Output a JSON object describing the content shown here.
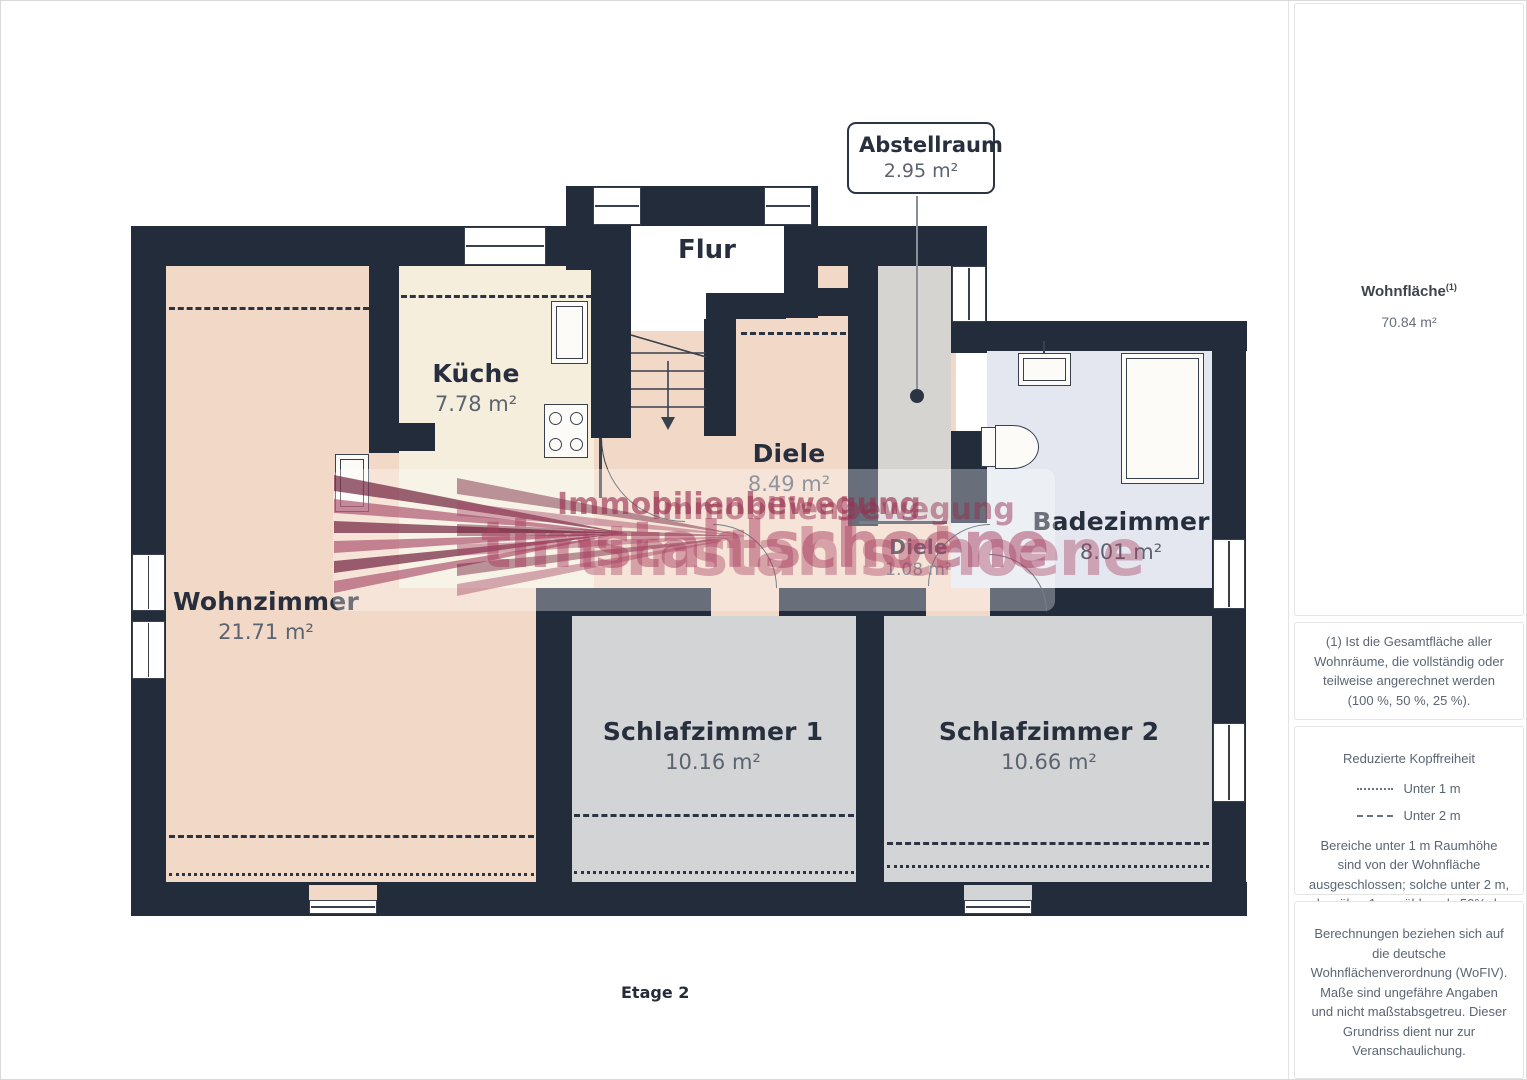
{
  "colors": {
    "wall": "#232c3b",
    "living_pink": "#f2d8c6",
    "kitchen_cream": "#f5eedc",
    "bath_lavender": "#e4e7ef",
    "bedroom_gray": "#d3d4d6",
    "storage_gray": "#d6d4d1",
    "watermark_red": "#a03a5e",
    "label_dark": "#272f3e",
    "area_gray": "#5b6370"
  },
  "floorplan": {
    "level_label": "Etage 2",
    "callout": {
      "title": "Abstellraum",
      "area": "2.95 m²"
    },
    "rooms": {
      "flur": {
        "name": "Flur"
      },
      "kueche": {
        "name": "Küche",
        "area": "7.78 m²"
      },
      "wohnzimmer": {
        "name": "Wohnzimmer",
        "area": "21.71 m²"
      },
      "diele": {
        "name": "Diele",
        "area": "8.49 m²"
      },
      "diele_klein": {
        "name": "Diele",
        "area": "1.08 m²"
      },
      "badezimmer": {
        "name": "Badezimmer",
        "area": "8.01 m²"
      },
      "schlafzimmer1": {
        "name": "Schlafzimmer 1",
        "area": "10.16 m²"
      },
      "schlafzimmer2": {
        "name": "Schlafzimmer 2",
        "area": "10.66 m²"
      }
    },
    "watermark": {
      "brand_line": "Immobilienbewegung",
      "logo_text": "timstahlschoene"
    }
  },
  "sidebar": {
    "total_area": {
      "label": "Wohnfläche",
      "footnote_ref": "(1)",
      "value": "70.84 m²"
    },
    "footnote": "(1) Ist die Gesamtfläche aller Wohnräume, die vollständig oder teilweise angerechnet werden (100 %, 50 %, 25 %).",
    "headroom": {
      "title": "Reduzierte Kopffreiheit",
      "legend": [
        {
          "label": "Unter 1 m"
        },
        {
          "label": "Unter 2 m"
        }
      ],
      "note": "Bereiche unter 1 m Raumhöhe sind von der Wohnfläche ausgeschlossen; solche unter 2 m, aber über 1 m, zählen als 50% der Wohnfläche"
    },
    "disclaimer": "Berechnungen beziehen sich auf die deutsche Wohnflächenverordnung (WoFIV). Maße sind ungefähre Angaben und nicht maßstabsgetreu. Dieser Grundriss dient nur zur Veranschaulichung.",
    "brand": {
      "name": "GIRAFFE",
      "suffix": "360"
    }
  }
}
